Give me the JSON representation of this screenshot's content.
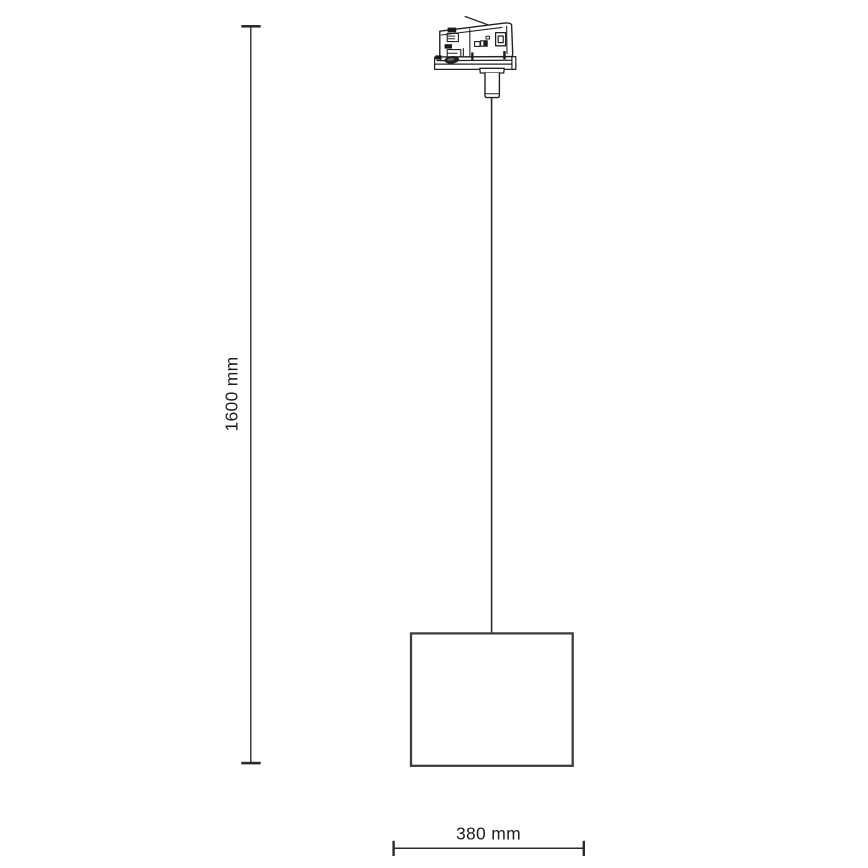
{
  "canvas": {
    "width": 868,
    "height": 868,
    "background": "#ffffff"
  },
  "diagram": {
    "type": "product-dimension-drawing",
    "parts": {
      "adapter": "3-circuit track adapter",
      "cable": "suspension cable",
      "shade": "drum shade"
    },
    "dimensions": {
      "height": {
        "label": "1600 mm",
        "value": 1600,
        "unit": "mm",
        "orientation": "vertical"
      },
      "width": {
        "label": "380 mm",
        "value": 380,
        "unit": "mm",
        "orientation": "horizontal"
      }
    },
    "colors": {
      "line": "#2b2b2b",
      "shade_outline": "#3e3e3e",
      "text": "#1f1f1f",
      "background": "#ffffff"
    }
  }
}
